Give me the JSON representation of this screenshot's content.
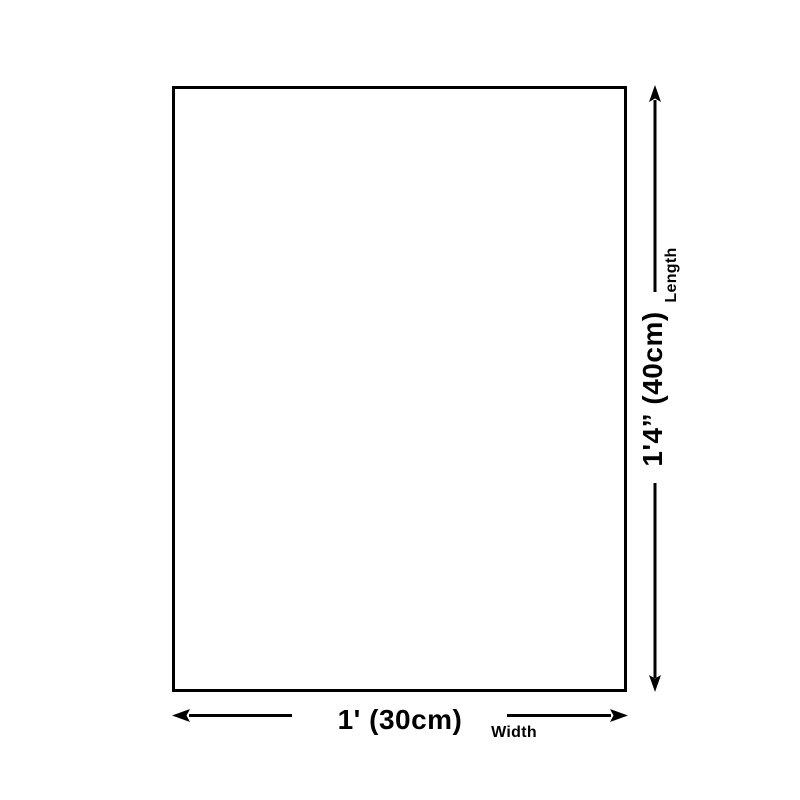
{
  "page": {
    "background_color": "#ffffff"
  },
  "diagram": {
    "type": "product-dimension-diagram",
    "shape": "rectangle",
    "line_color": "#000000",
    "length": {
      "value": "1'4” (40cm)",
      "label": "Length"
    },
    "width": {
      "value": "1' (30cm)",
      "label": "Width"
    }
  }
}
